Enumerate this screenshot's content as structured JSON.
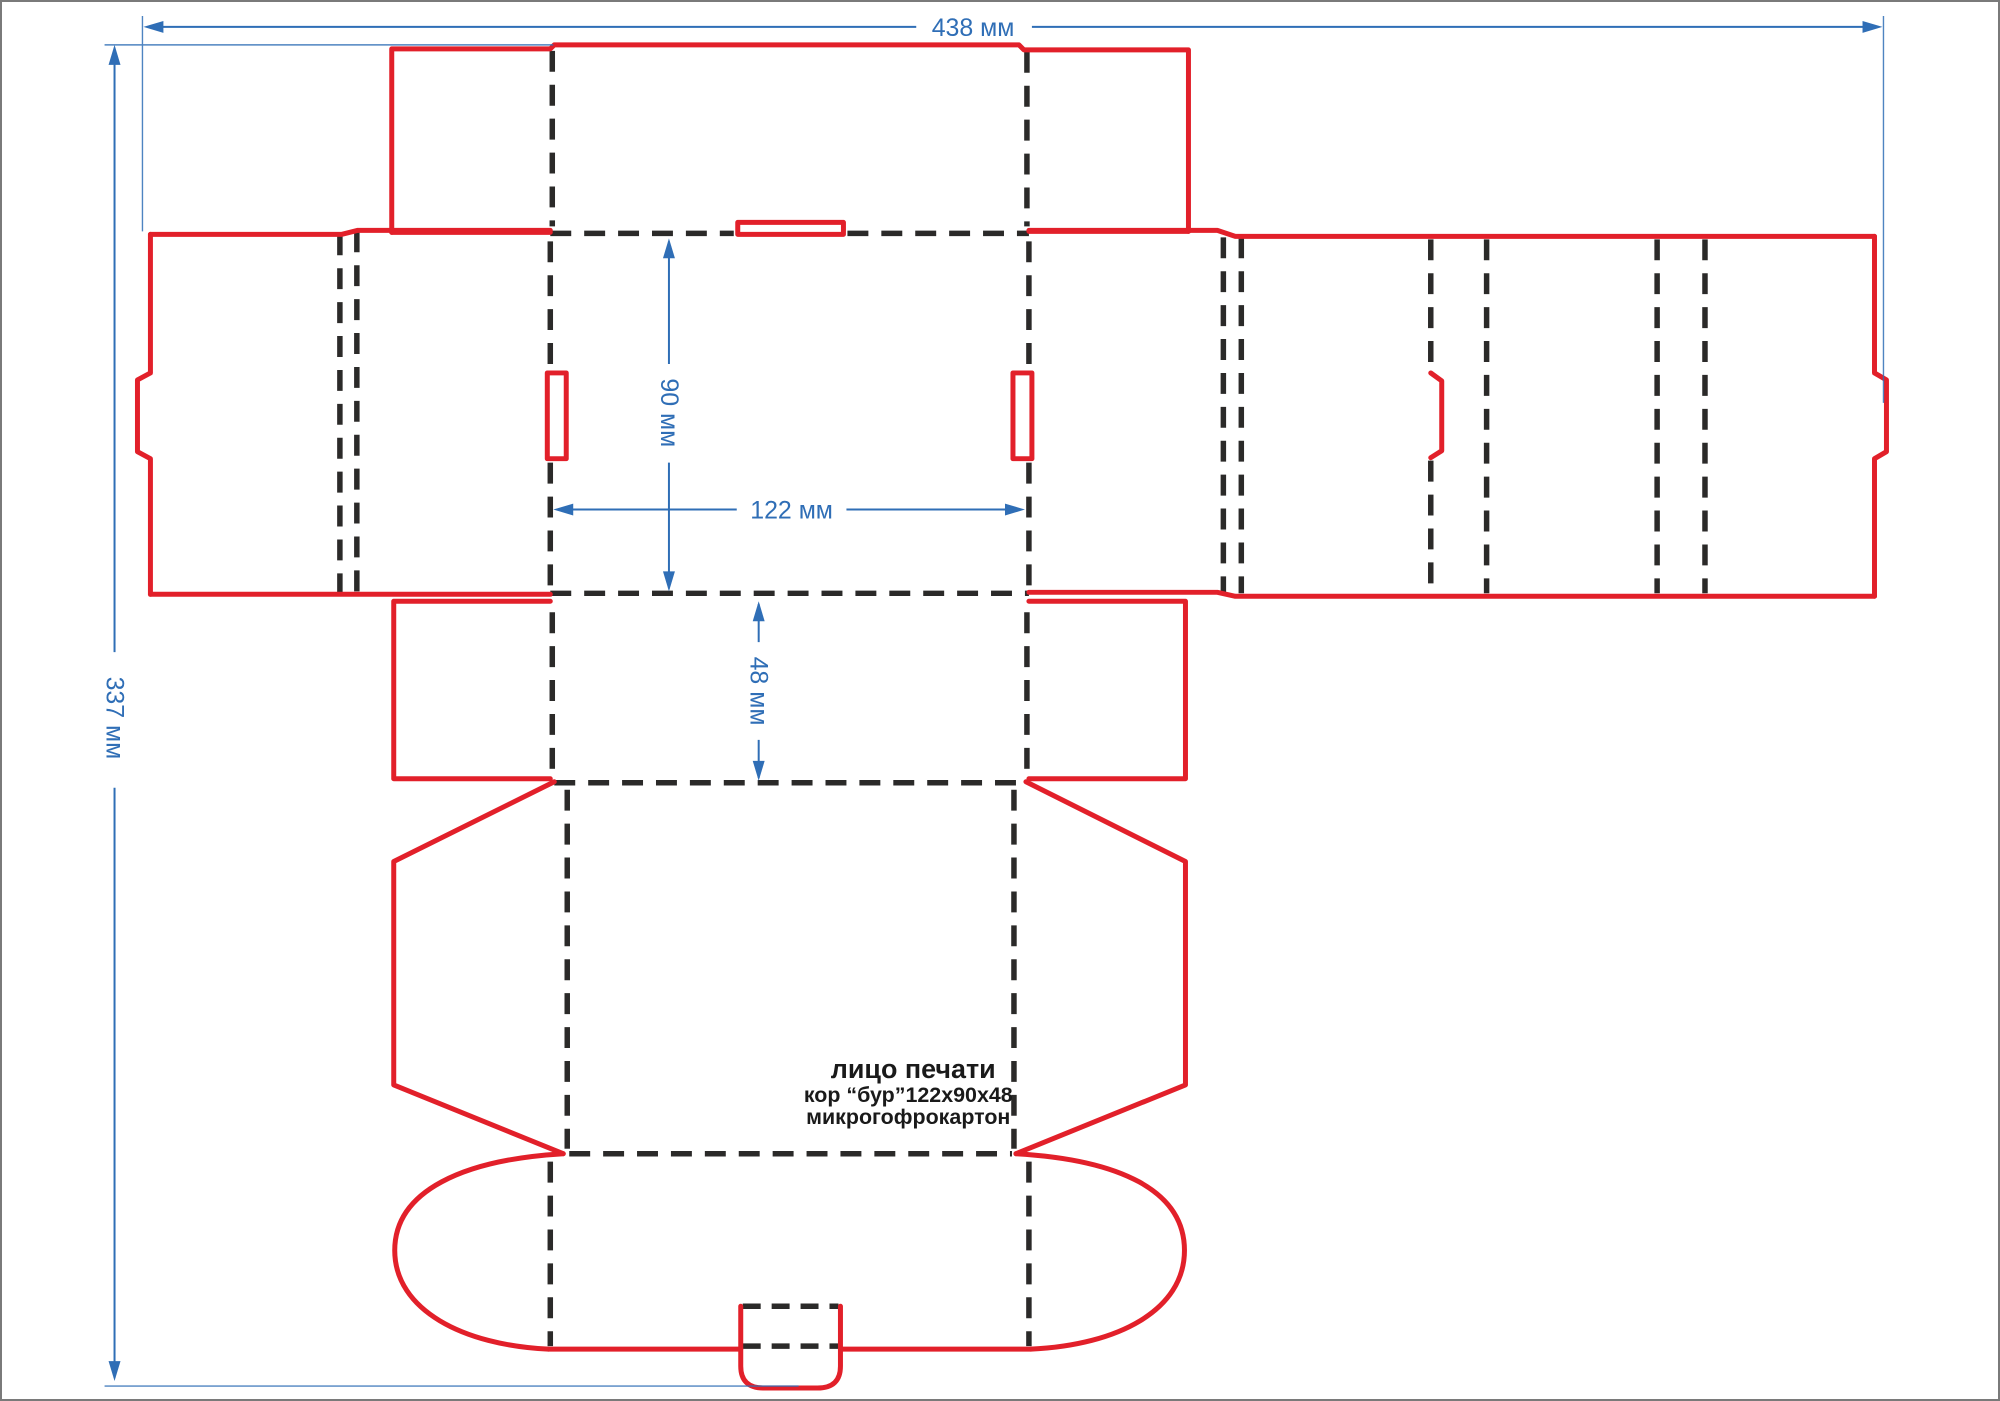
{
  "drawing_title": "box dieline 122x90x48",
  "dimensions": {
    "total_width": "438 мм",
    "total_height": "337 мм",
    "panel_height": "90 мм",
    "panel_width": "122 мм",
    "panel_depth": "48 мм"
  },
  "annotation": {
    "line1": "лицо печати",
    "line2": "кор “бур”122х90х48",
    "line3": "микрогофрокартон"
  },
  "legend": {
    "cut_line_meaning": "red = cut line",
    "fold_line_meaning": "black dashed = fold/crease line",
    "dim_line_meaning": "blue = dimension line"
  },
  "colors": {
    "cut-red": "#e2202a",
    "fold-black": "#2b2a29",
    "dim-blue": "#2f6eb6",
    "page-bg": "#ffffff",
    "page-border": "#7a7a7a"
  }
}
